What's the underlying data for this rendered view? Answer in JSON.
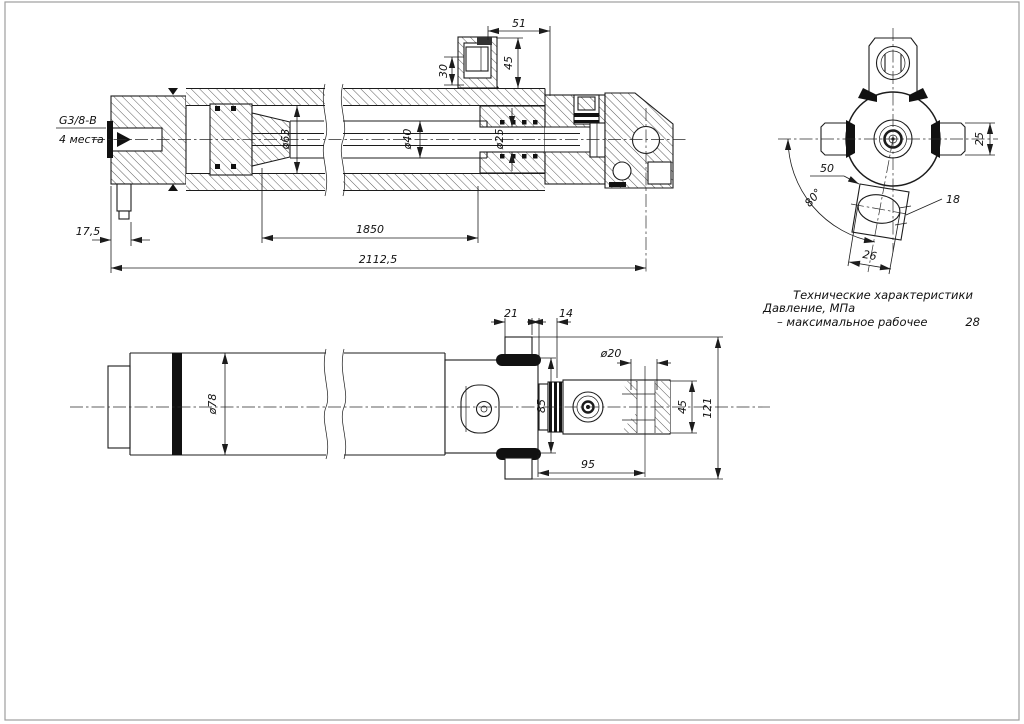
{
  "page": {
    "background": "#ffffff",
    "ink_color": "#1c1c1c",
    "frame_color": "#9e9e9e"
  },
  "views": {
    "main_section_view": {
      "port_label_line1": "G3/8-B",
      "port_label_line2": "4 места",
      "dims": {
        "boss_width": "51",
        "fitting_depth": "30",
        "boss_height": "45",
        "bore_dia": "ø63",
        "rod_dia": "ø40",
        "rod_end_dia": "ø25",
        "lug_offset": "17,5",
        "stroke_length": "1850",
        "overall_length": "2112,5"
      }
    },
    "end_view": {
      "dims": {
        "pin_height": "25",
        "lug_offset": "50",
        "lug_angle": "80°",
        "lug_thickness": "18",
        "slot_width": "26"
      }
    },
    "side_view": {
      "dims": {
        "pin_width": "21",
        "collar_width": "14",
        "eye_hole_dia": "ø20",
        "body_dia": "ø78",
        "head_height": "85",
        "eye_height": "45",
        "overall_height": "121",
        "eye_center_dist": "95"
      }
    },
    "specs": {
      "title": "Технические характеристики",
      "pressure_label": "Давление, МПа",
      "pressure_row_label": "– максимальное рабочее",
      "pressure_row_value": "28"
    }
  }
}
